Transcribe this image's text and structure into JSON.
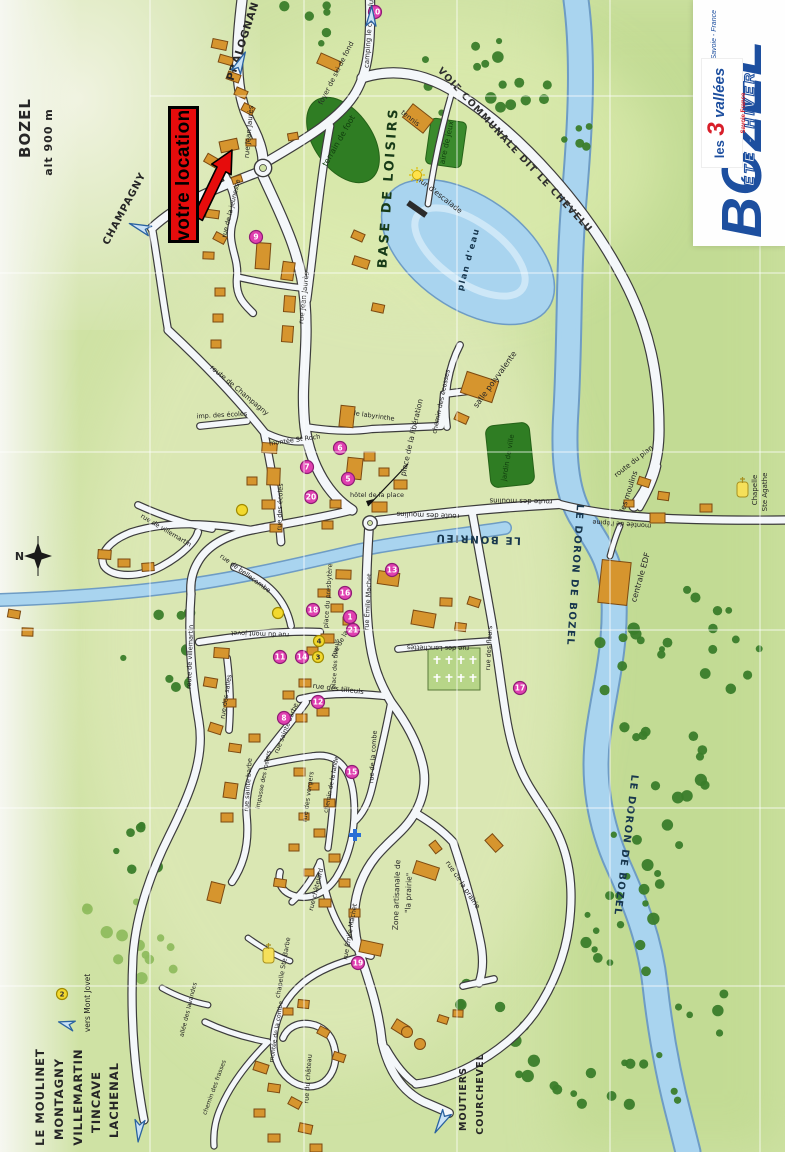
{
  "colors": {
    "accent_red": "#e60c0c",
    "logo_blue": "#1d4f9f",
    "marker_pink": "#e040b0",
    "water": "#a9d4ef",
    "building": "#d6952e",
    "road": "#f4f7fa",
    "ground": "#cfe2a4"
  },
  "location_flag": {
    "text": "votre location"
  },
  "logo": {
    "name": "BOZEL",
    "season": "ÉTÉ - HIVER",
    "region": "Savoie - France",
    "les3": {
      "prefix": "les",
      "number": "3",
      "suffix": "vallées",
      "sub": "Savoie France"
    }
  },
  "map": {
    "labels": [
      {
        "t": "BOZEL",
        "x": 30,
        "y": 128,
        "r": -90,
        "s": 15,
        "c": "h"
      },
      {
        "t": "alt 900 m",
        "x": 52,
        "y": 142,
        "r": -90,
        "s": 11,
        "c": "h"
      },
      {
        "t": "PRALOGNAN",
        "x": 246,
        "y": 42,
        "r": -72,
        "s": 10.5,
        "c": "h"
      },
      {
        "t": "CHAMPAGNY",
        "x": 127,
        "y": 210,
        "r": -62,
        "s": 10,
        "c": "h"
      },
      {
        "t": "LE MOULINET",
        "x": 44,
        "y": 1097,
        "r": -90,
        "s": 11.5,
        "c": "h"
      },
      {
        "t": "MONTAGNY",
        "x": 63,
        "y": 1099,
        "r": -90,
        "s": 11.5,
        "c": "h"
      },
      {
        "t": "VILLEMARTIN",
        "x": 82,
        "y": 1097,
        "r": -90,
        "s": 11.5,
        "c": "h"
      },
      {
        "t": "TINCAVE",
        "x": 100,
        "y": 1102,
        "r": -90,
        "s": 11.5,
        "c": "h"
      },
      {
        "t": "LACHENAL",
        "x": 118,
        "y": 1100,
        "r": -90,
        "s": 11.5,
        "c": "h"
      },
      {
        "t": "MOUTIERS",
        "x": 466,
        "y": 1099,
        "r": -90,
        "s": 9.5,
        "c": "h"
      },
      {
        "t": "COURCHEVEL",
        "x": 483,
        "y": 1094,
        "r": -90,
        "s": 9.5,
        "c": "h"
      },
      {
        "t": "vers Mont Jovet",
        "x": 90,
        "y": 1003,
        "r": -90,
        "s": 7.5,
        "c": "s"
      },
      {
        "t": "N",
        "x": 20,
        "y": 560,
        "r": 0,
        "s": 11,
        "c": "h"
      },
      {
        "t": "LE BONRIEU",
        "x": 478,
        "y": 536,
        "r": -178,
        "s": 10.5,
        "c": "r"
      },
      {
        "t": "LE DORON DE BOZEL",
        "x": 572,
        "y": 575,
        "r": 94,
        "s": 10,
        "c": "r"
      },
      {
        "t": "LE DORON DE BOZEL",
        "x": 623,
        "y": 845,
        "r": 97,
        "s": 10,
        "c": "r"
      },
      {
        "t": "BASE DE LOISIRS",
        "x": 392,
        "y": 188,
        "r": -86,
        "s": 13,
        "c": "B"
      },
      {
        "t": "VOIE COMMUNALE DIT LE CHEVELU",
        "x": 513,
        "y": 152,
        "r": 47,
        "s": 9.5,
        "c": "V"
      },
      {
        "t": "plan d'eau",
        "x": 471,
        "y": 260,
        "r": -75,
        "s": 8.5,
        "c": "r"
      },
      {
        "t": "terrain de foot",
        "x": 341,
        "y": 142,
        "r": -60,
        "s": 8,
        "c": "g"
      },
      {
        "t": "aire de jeux",
        "x": 449,
        "y": 143,
        "r": -78,
        "s": 7.5,
        "c": "g"
      },
      {
        "t": "mur d'escalade",
        "x": 437,
        "y": 196,
        "r": 38,
        "s": 7.5,
        "c": "a"
      },
      {
        "t": "foyer de ski de fond",
        "x": 338,
        "y": 74,
        "r": -63,
        "s": 7,
        "c": "a"
      },
      {
        "t": "camping le chevelu",
        "x": 371,
        "y": 34,
        "r": -86,
        "s": 7,
        "c": "a"
      },
      {
        "t": "tennis",
        "x": 409,
        "y": 120,
        "r": 38,
        "s": 7,
        "c": "a"
      },
      {
        "t": "salle polyvalente",
        "x": 497,
        "y": 381,
        "r": -54,
        "s": 8,
        "c": "a"
      },
      {
        "t": "jardin de ville",
        "x": 510,
        "y": 458,
        "r": -80,
        "s": 7,
        "c": "g"
      },
      {
        "t": "centrale EDF",
        "x": 643,
        "y": 578,
        "r": -74,
        "s": 8,
        "c": "a"
      },
      {
        "t": "les moulins",
        "x": 631,
        "y": 492,
        "r": -72,
        "s": 7.5,
        "c": "a"
      },
      {
        "t": "Chapelle",
        "x": 757,
        "y": 490,
        "r": -90,
        "s": 7,
        "c": "a"
      },
      {
        "t": "Ste Agathe",
        "x": 767,
        "y": 492,
        "r": -90,
        "s": 7,
        "c": "a"
      },
      {
        "t": "chapelle Ste Barbe",
        "x": 285,
        "y": 968,
        "r": -80,
        "s": 6.5,
        "c": "a"
      },
      {
        "t": "Zone artisanale de",
        "x": 399,
        "y": 895,
        "r": -88,
        "s": 7.5,
        "c": "a"
      },
      {
        "t": "\"la prairie\"",
        "x": 411,
        "y": 893,
        "r": -88,
        "s": 7.5,
        "c": "a"
      },
      {
        "t": "place de la libération",
        "x": 414,
        "y": 438,
        "r": -77,
        "s": 7.5,
        "c": "a"
      },
      {
        "t": "place du presbytère",
        "x": 330,
        "y": 596,
        "r": -86,
        "s": 6.5,
        "c": "a"
      },
      {
        "t": "hôtel de la place",
        "x": 377,
        "y": 497,
        "r": 0,
        "s": 6.5,
        "c": "a"
      },
      {
        "t": "rue Jean Jaurès",
        "x": 251,
        "y": 132,
        "r": -85,
        "s": 7,
        "c": "s"
      },
      {
        "t": "rue Jean Jaurès",
        "x": 306,
        "y": 298,
        "r": -84,
        "s": 7,
        "c": "s"
      },
      {
        "t": "rue de la jeunesse",
        "x": 233,
        "y": 209,
        "r": -76,
        "s": 6.5,
        "c": "s"
      },
      {
        "t": "route de Champagny",
        "x": 238,
        "y": 392,
        "r": 40,
        "s": 7,
        "c": "s"
      },
      {
        "t": "imp. des écoles",
        "x": 222,
        "y": 417,
        "r": -3,
        "s": 6.5,
        "c": "s"
      },
      {
        "t": "rue des écoles",
        "x": 282,
        "y": 507,
        "r": -88,
        "s": 6.5,
        "c": "s"
      },
      {
        "t": "montée St Roch",
        "x": 295,
        "y": 442,
        "r": -8,
        "s": 6.5,
        "c": "s"
      },
      {
        "t": "le labyrinthe",
        "x": 374,
        "y": 418,
        "r": 8,
        "s": 6.5,
        "c": "s"
      },
      {
        "t": "chemin des écosses",
        "x": 443,
        "y": 402,
        "r": -78,
        "s": 6.5,
        "c": "s"
      },
      {
        "t": "route des moulins",
        "x": 428,
        "y": 513,
        "r": 182,
        "s": 7,
        "c": "s"
      },
      {
        "t": "route des moulins",
        "x": 521,
        "y": 499,
        "r": 181,
        "s": 7,
        "c": "s"
      },
      {
        "t": "montée de l'épine",
        "x": 622,
        "y": 522,
        "r": 184,
        "s": 6.5,
        "c": "s"
      },
      {
        "t": "route du plan",
        "x": 635,
        "y": 463,
        "r": -38,
        "s": 7,
        "c": "s"
      },
      {
        "t": "rue des fleurs",
        "x": 491,
        "y": 648,
        "r": -87,
        "s": 6.5,
        "c": "s"
      },
      {
        "t": "rue des Lanchettes",
        "x": 438,
        "y": 646,
        "r": 181,
        "s": 6.5,
        "c": "s"
      },
      {
        "t": "rue des tilleuls",
        "x": 338,
        "y": 691,
        "r": 7,
        "s": 7,
        "c": "s"
      },
      {
        "t": "place des tilleuls",
        "x": 337,
        "y": 664,
        "r": -86,
        "s": 6,
        "c": "s"
      },
      {
        "t": "rue de la poste",
        "x": 346,
        "y": 636,
        "r": -62,
        "s": 6.5,
        "c": "s"
      },
      {
        "t": "rue Émile Machet",
        "x": 370,
        "y": 602,
        "r": -87,
        "s": 6.5,
        "c": "s"
      },
      {
        "t": "rue Émile Machet",
        "x": 352,
        "y": 932,
        "r": -80,
        "s": 6.5,
        "c": "s"
      },
      {
        "t": "rue du mont jovet",
        "x": 260,
        "y": 632,
        "r": 182,
        "s": 6.5,
        "c": "s"
      },
      {
        "t": "rue de bellecombe",
        "x": 244,
        "y": 575,
        "r": 36,
        "s": 6.5,
        "c": "s"
      },
      {
        "t": "rue de villemartin",
        "x": 165,
        "y": 532,
        "r": 31,
        "s": 6.5,
        "c": "s"
      },
      {
        "t": "route de villemartin",
        "x": 192,
        "y": 657,
        "r": -88,
        "s": 6.5,
        "c": "s"
      },
      {
        "t": "rue des salles",
        "x": 228,
        "y": 697,
        "r": -81,
        "s": 6.5,
        "c": "s"
      },
      {
        "t": "rue sainte barbe",
        "x": 288,
        "y": 729,
        "r": -68,
        "s": 6.5,
        "c": "s"
      },
      {
        "t": "rue sainte barbe",
        "x": 250,
        "y": 785,
        "r": -86,
        "s": 6.5,
        "c": "s"
      },
      {
        "t": "impasse des rosiers",
        "x": 265,
        "y": 780,
        "r": -79,
        "s": 6,
        "c": "s"
      },
      {
        "t": "rue des vergers",
        "x": 310,
        "y": 797,
        "r": -82,
        "s": 6.5,
        "c": "s"
      },
      {
        "t": "chemin de la lande",
        "x": 333,
        "y": 785,
        "r": -79,
        "s": 6,
        "c": "s"
      },
      {
        "t": "rue de la combe",
        "x": 375,
        "y": 757,
        "r": -86,
        "s": 6.5,
        "c": "s"
      },
      {
        "t": "rue châtelard",
        "x": 318,
        "y": 890,
        "r": -76,
        "s": 6.5,
        "c": "s"
      },
      {
        "t": "rue de la prairie",
        "x": 461,
        "y": 886,
        "r": 56,
        "s": 7,
        "c": "s"
      },
      {
        "t": "chemin des frasses",
        "x": 216,
        "y": 1088,
        "r": -70,
        "s": 6,
        "c": "s"
      },
      {
        "t": "montée de la combe",
        "x": 278,
        "y": 1032,
        "r": -81,
        "s": 6,
        "c": "s"
      },
      {
        "t": "rue du château",
        "x": 310,
        "y": 1079,
        "r": -86,
        "s": 6.5,
        "c": "s"
      },
      {
        "t": "allée des lavandes",
        "x": 190,
        "y": 1010,
        "r": -76,
        "s": 6,
        "c": "s"
      }
    ],
    "markers": [
      {
        "n": "10",
        "x": 375,
        "y": 12,
        "k": "p"
      },
      {
        "n": "9",
        "x": 256,
        "y": 237,
        "k": "p"
      },
      {
        "n": "7",
        "x": 307,
        "y": 467,
        "k": "p"
      },
      {
        "n": "6",
        "x": 340,
        "y": 448,
        "k": "p"
      },
      {
        "n": "5",
        "x": 348,
        "y": 479,
        "k": "p"
      },
      {
        "n": "20",
        "x": 311,
        "y": 497,
        "k": "p"
      },
      {
        "n": "13",
        "x": 392,
        "y": 570,
        "k": "p"
      },
      {
        "n": "16",
        "x": 345,
        "y": 593,
        "k": "p"
      },
      {
        "n": "18",
        "x": 313,
        "y": 610,
        "k": "p"
      },
      {
        "n": "1",
        "x": 350,
        "y": 617,
        "k": "p"
      },
      {
        "n": "21",
        "x": 353,
        "y": 630,
        "k": "p"
      },
      {
        "n": "11",
        "x": 280,
        "y": 657,
        "k": "p"
      },
      {
        "n": "14",
        "x": 302,
        "y": 657,
        "k": "p"
      },
      {
        "n": "12",
        "x": 318,
        "y": 702,
        "k": "p"
      },
      {
        "n": "8",
        "x": 284,
        "y": 718,
        "k": "p"
      },
      {
        "n": "17",
        "x": 520,
        "y": 688,
        "k": "p"
      },
      {
        "n": "15",
        "x": 352,
        "y": 772,
        "k": "p"
      },
      {
        "n": "19",
        "x": 358,
        "y": 963,
        "k": "p"
      },
      {
        "n": "3",
        "x": 318,
        "y": 657,
        "k": "y"
      },
      {
        "n": "4",
        "x": 319,
        "y": 641,
        "k": "y"
      },
      {
        "n": "",
        "x": 242,
        "y": 510,
        "k": "y"
      },
      {
        "n": "",
        "x": 278,
        "y": 613,
        "k": "y"
      },
      {
        "n": "2",
        "x": 62,
        "y": 994,
        "k": "y"
      },
      {
        "n": "",
        "x": 355,
        "y": 835,
        "k": "c"
      },
      {
        "n": "",
        "x": 417,
        "y": 175,
        "k": "s"
      }
    ]
  }
}
